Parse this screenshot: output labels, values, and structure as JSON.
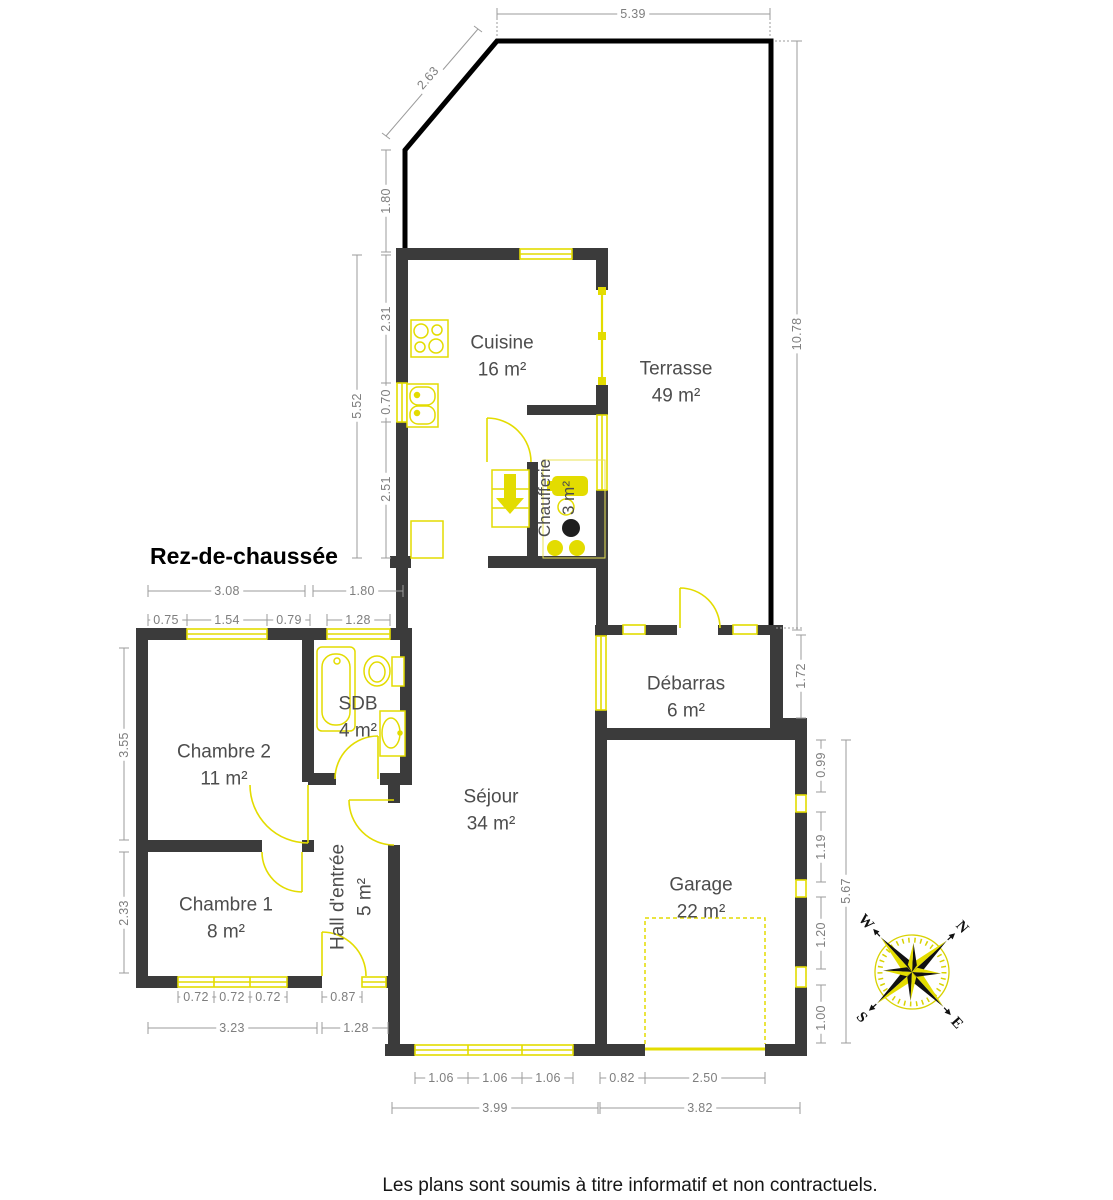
{
  "title": "Rez-de-chaussée",
  "footer": "Les plans sont soumis à titre informatif et non contractuels.",
  "colors": {
    "wall": "#3b3b3b",
    "terrace_outline": "#000000",
    "feature_yellow": "#e3dc00",
    "dimension_gray": "#9b9b9b",
    "label_gray": "#4d4d4d"
  },
  "rooms": [
    {
      "name": "Cuisine",
      "area": "16 m²"
    },
    {
      "name": "Terrasse",
      "area": "49 m²"
    },
    {
      "name": "Chaufferie",
      "area": "3 m²"
    },
    {
      "name": "Débarras",
      "area": "6 m²"
    },
    {
      "name": "Séjour",
      "area": "34 m²"
    },
    {
      "name": "Chambre 2",
      "area": "11 m²"
    },
    {
      "name": "SDB",
      "area": "4 m²"
    },
    {
      "name": "Chambre 1",
      "area": "8 m²"
    },
    {
      "name": "Hall d'entrée",
      "area": "5 m²"
    },
    {
      "name": "Garage",
      "area": "22 m²"
    }
  ],
  "dims": {
    "top_width": "5.39",
    "diagonal": "2.63",
    "terrace_left": "1.80",
    "terrace_right": "10.78",
    "kitchen_total": "5.52",
    "kitchen_a": "2.31",
    "kitchen_b": "0.70",
    "kitchen_c": "2.51",
    "ch2_total": "3.08",
    "ch2_a": "0.75",
    "ch2_b": "1.54",
    "ch2_c": "0.79",
    "sdb_total": "1.80",
    "sdb_window": "1.28",
    "ch2_left": "3.55",
    "ch1_left": "2.33",
    "ch1_a": "0.72",
    "ch1_b": "0.72",
    "ch1_c": "0.72",
    "ch1_total": "3.23",
    "hall_door": "0.87",
    "hall_total": "1.28",
    "sej_a": "1.06",
    "sej_b": "1.06",
    "sej_c": "1.06",
    "sej_total": "3.99",
    "gar_a": "0.82",
    "gar_door": "2.50",
    "gar_total": "3.82",
    "deb_right": "1.72",
    "gr_a": "0.99",
    "gr_b": "1.19",
    "gr_c": "1.20",
    "gr_d": "1.00",
    "gr_total": "5.67"
  },
  "compass": {
    "north": "N",
    "east": "E",
    "south": "S",
    "west": "W"
  }
}
